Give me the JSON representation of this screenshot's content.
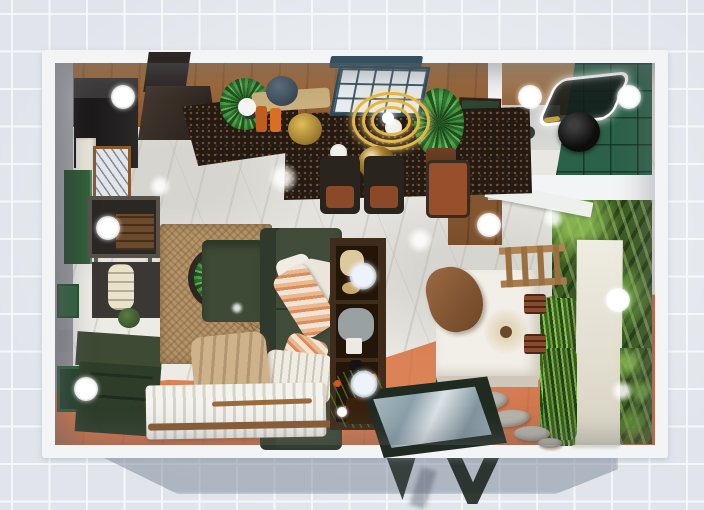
{
  "app": {
    "name": "3d-floorplan-viewport",
    "view": "top-down render"
  },
  "palette": {
    "background_tile": "#e1e5eb",
    "tile_grout": "#f4f6f9",
    "wall_white": "#f3f4f6",
    "cast_shadow": "rgba(122,134,152,0.5)",
    "marble_floor": "#edebe6",
    "wood_floor": "#96633a",
    "terracotta_floor": "#cb7048",
    "sofa_green": "#414c3a",
    "bathroom_tile_green": "#2c6149",
    "palm_wall_green": "#3c5c22",
    "counter_speckled_dark": "#221a13",
    "pendant_gold": "#e3b64a",
    "partition_cream": "#e9e6da"
  },
  "hotspots": [
    {
      "x": 123,
      "y": 97,
      "tint": "white"
    },
    {
      "x": 530,
      "y": 97,
      "tint": "white"
    },
    {
      "x": 629,
      "y": 97,
      "tint": "white"
    },
    {
      "x": 108,
      "y": 228,
      "tint": "white"
    },
    {
      "x": 489,
      "y": 225,
      "tint": "white"
    },
    {
      "x": 618,
      "y": 300,
      "tint": "white"
    },
    {
      "x": 86,
      "y": 389,
      "tint": "white"
    },
    {
      "x": 363,
      "y": 276,
      "tint": "blue"
    },
    {
      "x": 364,
      "y": 384,
      "tint": "blue"
    }
  ],
  "glows": [
    {
      "x": 283,
      "y": 178,
      "r": 15
    },
    {
      "x": 420,
      "y": 240,
      "r": 13
    },
    {
      "x": 160,
      "y": 186,
      "r": 11
    },
    {
      "x": 553,
      "y": 218,
      "r": 11
    },
    {
      "x": 237,
      "y": 308,
      "r": 6
    },
    {
      "x": 622,
      "y": 391,
      "r": 11
    },
    {
      "x": 342,
      "y": 412,
      "r": 7
    }
  ]
}
